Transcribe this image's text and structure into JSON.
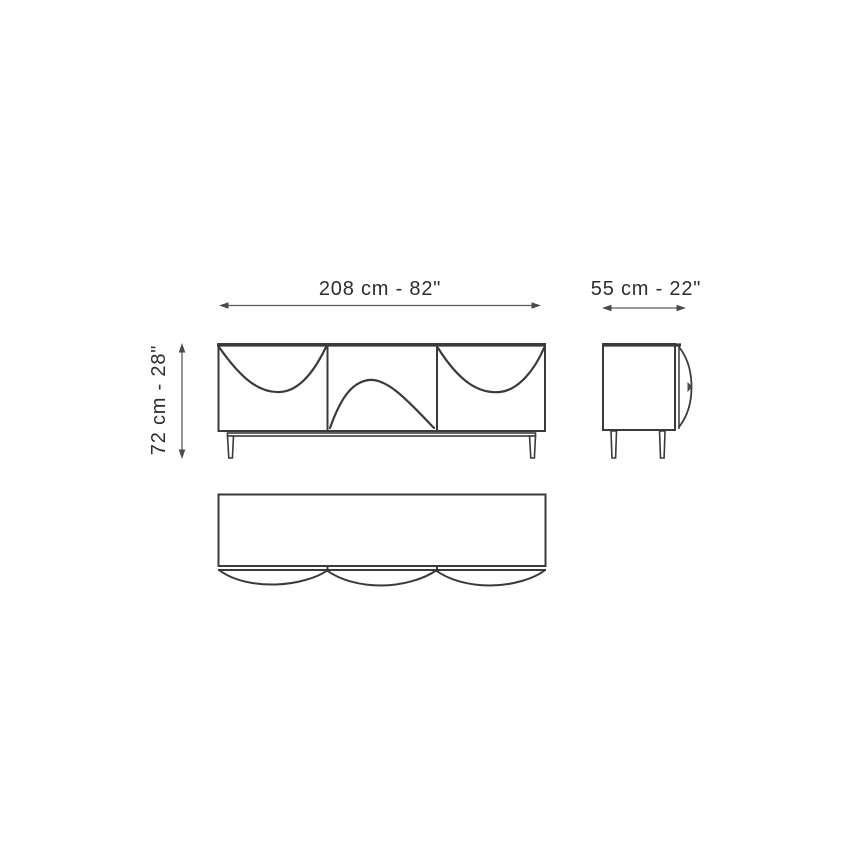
{
  "page": {
    "background": "#ffffff",
    "kind": "furniture dimension drawing"
  },
  "palette": {
    "drawing_line": "#3a3a3a",
    "dimension_line": "#5c5c5c",
    "label_text": "#2d2d2d"
  },
  "dimensions": {
    "width": {
      "label": "208 cm - 82\"",
      "cm": "208",
      "inches": "82"
    },
    "depth": {
      "label": "55 cm - 22\"",
      "cm": "55",
      "inches": "22"
    },
    "height": {
      "label": "72 cm - 28\"",
      "cm": "72",
      "inches": "28"
    }
  }
}
